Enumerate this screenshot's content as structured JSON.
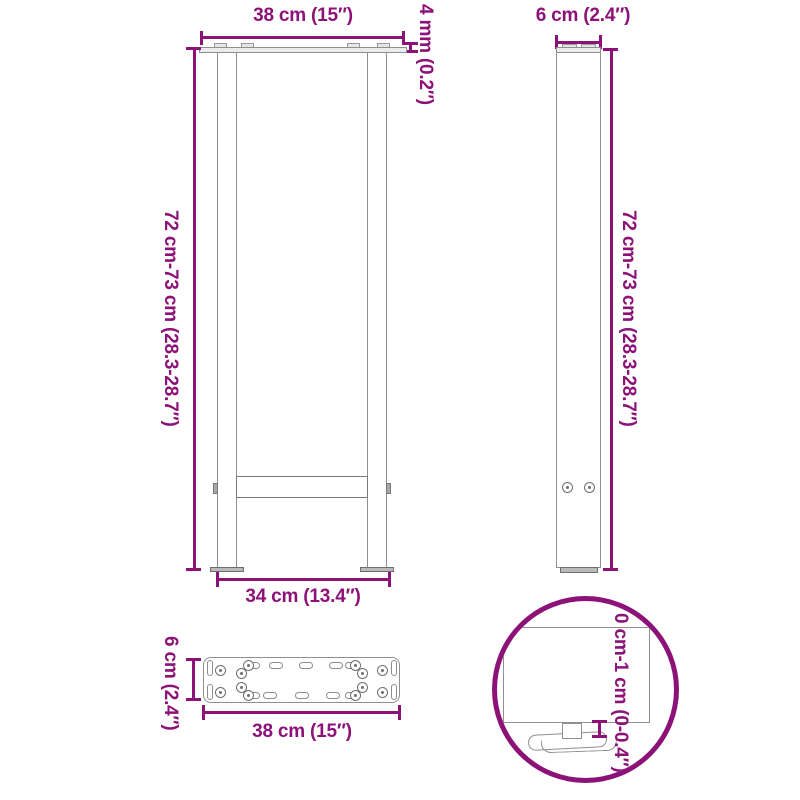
{
  "labels": {
    "front_top_width": "38 cm (15″)",
    "front_plate_thickness": "4 mm (0.2″)",
    "front_height_range": "72 cm-73 cm (28.3-28.7″)",
    "front_bottom_width": "34 cm (13.4″)",
    "side_depth": "6 cm (2.4″)",
    "side_height_range": "72 cm-73 cm (28.3-28.7″)",
    "plate_depth": "6 cm (2.4″)",
    "plate_width": "38 cm (15″)",
    "foot_adjustment_range": "0 cm-1 cm (0-0.4″)"
  },
  "colors": {
    "dimension_accent": "#8D1278",
    "structure_outline": "#8C8C8C",
    "background": "#FFFFFF"
  }
}
